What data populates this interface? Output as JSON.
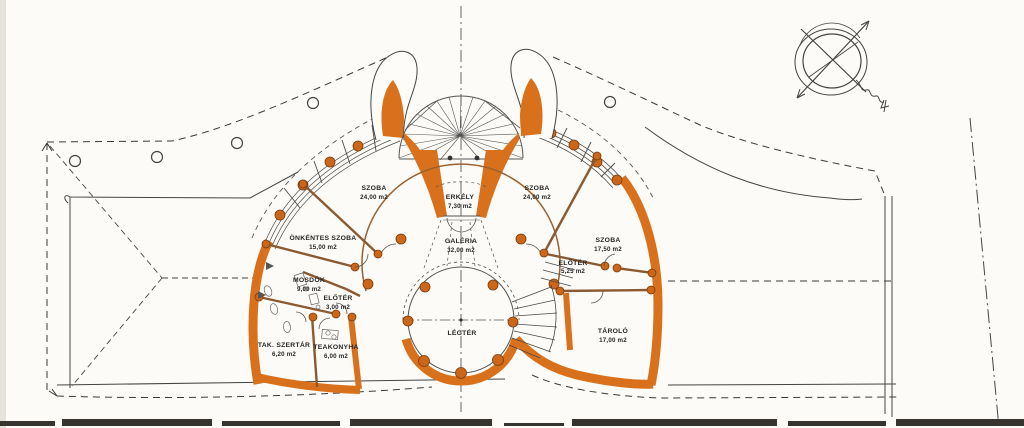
{
  "meta": {
    "drawing_type": "architectural floor plan (scanned, hand drafted)",
    "language": "Hungarian"
  },
  "colors": {
    "wall_orange": "#d9711c",
    "partition_brown": "#8a5a32",
    "ink": "#3a3a3a",
    "paper": "#fcfbf7"
  },
  "rooms": [
    {
      "id": "szoba-left",
      "name": "SZOBA",
      "area": "24,00 m2"
    },
    {
      "id": "erkely",
      "name": "ERKÉLY",
      "area": "7,30 m2"
    },
    {
      "id": "szoba-right",
      "name": "SZOBA",
      "area": "24,00 m2"
    },
    {
      "id": "galeria",
      "name": "GALÉRIA",
      "area": "32,00 m2"
    },
    {
      "id": "onkentes-szoba",
      "name": "ÖNKÉNTES SZOBA",
      "area": "15,00 m2"
    },
    {
      "id": "mosdok",
      "name": "MOSDÓK",
      "area": "9,00 m2"
    },
    {
      "id": "eloter-left",
      "name": "ELŐTÉR",
      "area": "3,00 m2"
    },
    {
      "id": "tak-szertar",
      "name": "TAK. SZERTÁR",
      "area": "6,20 m2"
    },
    {
      "id": "teakonyha",
      "name": "TEAKONYHA",
      "area": "6,00 m2"
    },
    {
      "id": "szoba-east",
      "name": "SZOBA",
      "area": "17,50 m2"
    },
    {
      "id": "eloter-right",
      "name": "ELŐTÉR",
      "area": "5,25 m2"
    },
    {
      "id": "tarolo",
      "name": "TÁROLÓ",
      "area": "17,00 m2"
    },
    {
      "id": "legter",
      "name": "LÉGTÉR",
      "area": ""
    }
  ],
  "symbols": {
    "compass": "north-arrow sketch with crossing arrows",
    "trees": 5
  }
}
